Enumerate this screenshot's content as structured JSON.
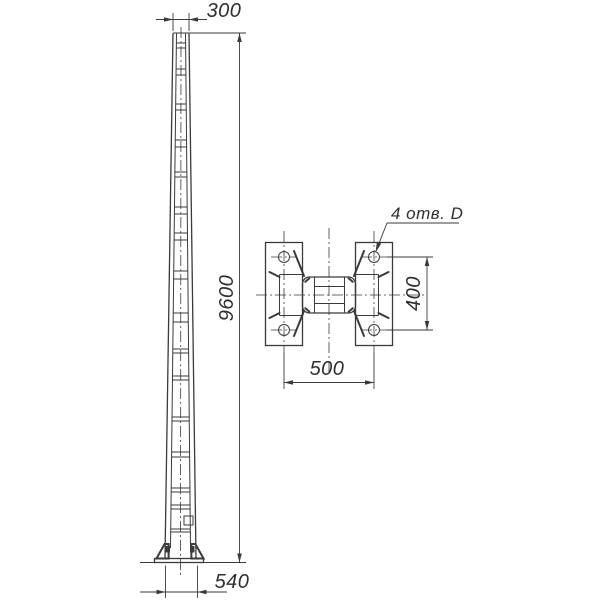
{
  "document": {
    "type": "engineering-drawing",
    "subject": "tapered-pole-with-anchor-base",
    "language": "ru"
  },
  "elevation_view": {
    "dim_top_width": "300",
    "dim_height": "9600",
    "dim_base_width": "540"
  },
  "plan_view": {
    "callout_holes": "4 отв. D",
    "dim_hole_spacing_vertical": "400",
    "dim_hole_spacing_horizontal": "500"
  },
  "colors": {
    "line": "#3a3a3a",
    "text": "#2f2f2f",
    "background": "#ffffff"
  }
}
